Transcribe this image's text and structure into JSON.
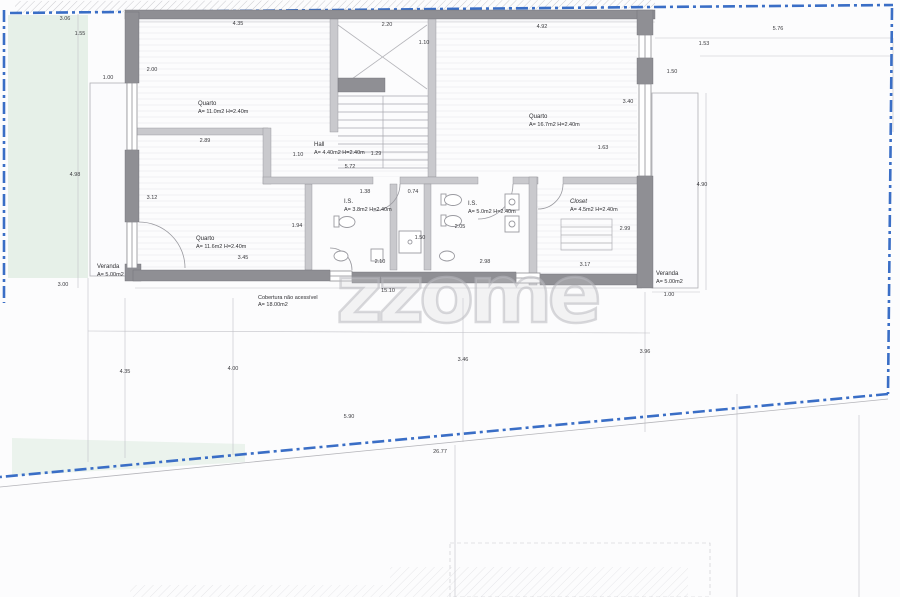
{
  "document": {
    "kind": "architectural floor plan (scanned)"
  },
  "watermark": "zzome",
  "colors": {
    "boundary_blue": "#3a6ec6",
    "wall_dark": "#8f8f94",
    "wall_light": "#c9c9cd",
    "green_area": "#e6f0e8",
    "thin_line": "#9a9aa0"
  },
  "rooms": [
    {
      "name": "Quarto",
      "detail": "A= 11.0m2 H=2.40m"
    },
    {
      "name": "Quarto",
      "detail": "A= 16.7m2 H=2.40m"
    },
    {
      "name": "Quarto",
      "detail": "A= 11.6m2 H=2.40m"
    },
    {
      "name": "Hall",
      "detail": "A= 4.40m2 H=2.40m"
    },
    {
      "name": "I.S.",
      "detail": "A= 3.8m2 H=2.40m"
    },
    {
      "name": "I.S.",
      "detail": "A= 5.0m2 H=2.40m"
    },
    {
      "name": "Closet",
      "detail": "A= 4.5m2 H=2.40m"
    },
    {
      "name": "Veranda",
      "detail": "A= 5.00m2"
    },
    {
      "name": "Veranda",
      "detail": "A= 5.00m2"
    },
    {
      "name": "Cobertura não acessível",
      "detail": "A= 18.00m2"
    }
  ],
  "dimensions": [
    {
      "t": "3.06",
      "x": 65,
      "y": 19
    },
    {
      "t": "1.55",
      "x": 80,
      "y": 34
    },
    {
      "t": "1.00",
      "x": 108,
      "y": 78
    },
    {
      "t": "2.00",
      "x": 152,
      "y": 70
    },
    {
      "t": "4.35",
      "x": 238,
      "y": 24
    },
    {
      "t": "2.20",
      "x": 387,
      "y": 25
    },
    {
      "t": "1.10",
      "x": 424,
      "y": 43
    },
    {
      "t": "4.92",
      "x": 542,
      "y": 27
    },
    {
      "t": "1.53",
      "x": 704,
      "y": 44
    },
    {
      "t": "5.76",
      "x": 778,
      "y": 29
    },
    {
      "t": "2.89",
      "x": 205,
      "y": 141
    },
    {
      "t": "1.10",
      "x": 298,
      "y": 155
    },
    {
      "t": "1.29",
      "x": 376,
      "y": 154
    },
    {
      "t": "5.72",
      "x": 350,
      "y": 167
    },
    {
      "t": "1.63",
      "x": 603,
      "y": 148
    },
    {
      "t": "1.38",
      "x": 365,
      "y": 192
    },
    {
      "t": "0.74",
      "x": 413,
      "y": 192
    },
    {
      "t": "3.12",
      "x": 152,
      "y": 198
    },
    {
      "t": "1.94",
      "x": 297,
      "y": 226
    },
    {
      "t": "2.05",
      "x": 460,
      "y": 227
    },
    {
      "t": "2.99",
      "x": 625,
      "y": 229
    },
    {
      "t": "1.50",
      "x": 420,
      "y": 238
    },
    {
      "t": "3.45",
      "x": 243,
      "y": 258
    },
    {
      "t": "2.10",
      "x": 380,
      "y": 262
    },
    {
      "t": "2.98",
      "x": 485,
      "y": 262
    },
    {
      "t": "3.17",
      "x": 585,
      "y": 265
    },
    {
      "t": "3.40",
      "x": 628,
      "y": 102
    },
    {
      "t": "1.50",
      "x": 672,
      "y": 72
    },
    {
      "t": "4.90",
      "x": 702,
      "y": 185
    },
    {
      "t": "4.98",
      "x": 75,
      "y": 175
    },
    {
      "t": "3.00",
      "x": 63,
      "y": 285
    },
    {
      "t": "1.00",
      "x": 669,
      "y": 295
    },
    {
      "t": "15.10",
      "x": 388,
      "y": 291
    },
    {
      "t": "4.35",
      "x": 125,
      "y": 372
    },
    {
      "t": "4.00",
      "x": 233,
      "y": 369
    },
    {
      "t": "3.46",
      "x": 463,
      "y": 360
    },
    {
      "t": "3.96",
      "x": 645,
      "y": 352
    },
    {
      "t": "5.90",
      "x": 349,
      "y": 417
    },
    {
      "t": "26.77",
      "x": 440,
      "y": 452
    }
  ]
}
